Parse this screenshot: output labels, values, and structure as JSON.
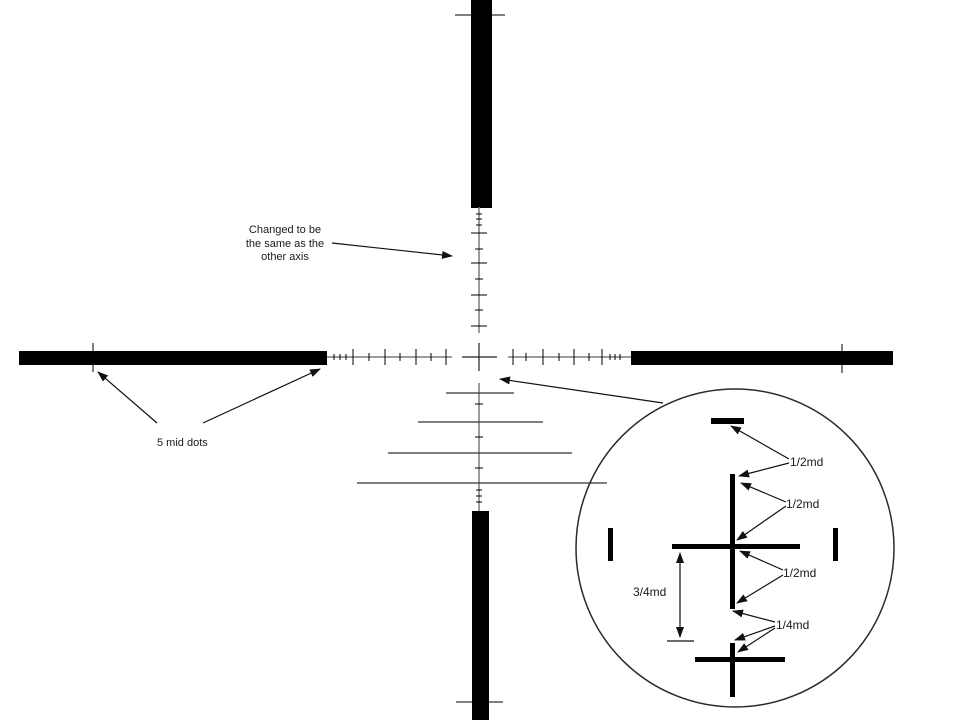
{
  "title": "Mil-dot reticle design diagram",
  "canvas": {
    "w": 960,
    "h": 720,
    "bg": "#ffffff"
  },
  "colors": {
    "ink": "#000000",
    "stem": "#7b7b7b",
    "cross": "#222222",
    "rung": "#333333",
    "tick": "#000000",
    "arrow": "#111111",
    "circle": "#2a2a2a",
    "text": "#1a1a1a"
  },
  "notes": {
    "axis_note": {
      "lines": [
        "Changed to be",
        "the same as the",
        "other axis"
      ]
    },
    "mid_dots_note": {
      "text": "5 mid dots"
    }
  },
  "inset": {
    "labels": [
      {
        "id": "half-md-1",
        "text": "1/2md"
      },
      {
        "id": "half-md-2",
        "text": "1/2md"
      },
      {
        "id": "half-md-3",
        "text": "1/2md"
      },
      {
        "id": "quarter-md",
        "text": "1/4md"
      },
      {
        "id": "three-quarter-md",
        "text": "3/4md"
      }
    ]
  },
  "geometry": {
    "bars": [
      {
        "id": "top-bar",
        "x": 471,
        "y": 0,
        "w": 21,
        "h": 208
      },
      {
        "id": "left-bar",
        "x": 19,
        "y": 351,
        "w": 308,
        "h": 14
      },
      {
        "id": "right-bar",
        "x": 631,
        "y": 351,
        "w": 262,
        "h": 14
      },
      {
        "id": "bottom-bar",
        "x": 472,
        "y": 511,
        "w": 17,
        "h": 209
      }
    ],
    "stems": [
      {
        "id": "upper-stem",
        "p": [
          479,
          207,
          479,
          333
        ]
      },
      {
        "id": "left-stem",
        "p": [
          327,
          357,
          452,
          357
        ]
      },
      {
        "id": "right-stem",
        "p": [
          508,
          357,
          631,
          357
        ]
      },
      {
        "id": "ladder-stem",
        "p": [
          479,
          383,
          479,
          511
        ]
      }
    ],
    "cross": [
      {
        "id": "center-cross-v",
        "p": [
          479,
          343,
          479,
          371
        ]
      },
      {
        "id": "center-cross-h",
        "p": [
          462,
          357,
          497,
          357
        ]
      }
    ],
    "rungs": [
      {
        "id": "ladder-rung-1",
        "p": [
          446,
          393,
          514,
          393
        ]
      },
      {
        "id": "ladder-rung-2",
        "p": [
          418,
          422,
          543,
          422
        ]
      },
      {
        "id": "ladder-rung-3",
        "p": [
          388,
          453,
          572,
          453
        ]
      },
      {
        "id": "ladder-rung-4",
        "p": [
          357,
          483,
          607,
          483
        ]
      }
    ],
    "ticks": [
      {
        "id": "top-bar-tick",
        "p": [
          455,
          15,
          505,
          15
        ]
      },
      {
        "id": "bottom-bar-tick",
        "p": [
          456,
          702,
          503,
          702
        ]
      },
      {
        "id": "left-bar-mid-dot-tick",
        "p": [
          93,
          343,
          93,
          372
        ]
      },
      {
        "id": "right-bar-mid-dot-tick",
        "p": [
          842,
          344,
          842,
          373
        ]
      },
      {
        "id": "upper-fine-tick",
        "p": [
          476,
          214,
          482,
          214
        ]
      },
      {
        "id": "upper-fine-tick",
        "p": [
          476,
          219,
          482,
          219
        ]
      },
      {
        "id": "upper-fine-tick",
        "p": [
          476,
          225,
          482,
          225
        ]
      },
      {
        "id": "upper-long-tick",
        "p": [
          471,
          233,
          487,
          233
        ]
      },
      {
        "id": "upper-short-tick",
        "p": [
          475,
          249,
          483,
          249
        ]
      },
      {
        "id": "upper-long-tick",
        "p": [
          471,
          263,
          487,
          263
        ]
      },
      {
        "id": "upper-short-tick",
        "p": [
          475,
          279,
          483,
          279
        ]
      },
      {
        "id": "upper-long-tick",
        "p": [
          471,
          295,
          487,
          295
        ]
      },
      {
        "id": "upper-short-tick",
        "p": [
          475,
          310,
          483,
          310
        ]
      },
      {
        "id": "upper-long-tick",
        "p": [
          471,
          326,
          487,
          326
        ]
      },
      {
        "id": "left-fine-tick",
        "p": [
          334,
          354,
          334,
          360
        ]
      },
      {
        "id": "left-fine-tick",
        "p": [
          340,
          354,
          340,
          360
        ]
      },
      {
        "id": "left-fine-tick",
        "p": [
          346,
          354,
          346,
          360
        ]
      },
      {
        "id": "left-long-tick",
        "p": [
          353,
          349,
          353,
          365
        ]
      },
      {
        "id": "left-short-tick",
        "p": [
          369,
          353,
          369,
          361
        ]
      },
      {
        "id": "left-long-tick",
        "p": [
          385,
          349,
          385,
          365
        ]
      },
      {
        "id": "left-short-tick",
        "p": [
          400,
          353,
          400,
          361
        ]
      },
      {
        "id": "left-long-tick",
        "p": [
          416,
          349,
          416,
          365
        ]
      },
      {
        "id": "left-short-tick",
        "p": [
          431,
          353,
          431,
          361
        ]
      },
      {
        "id": "left-long-tick",
        "p": [
          446,
          349,
          446,
          365
        ]
      },
      {
        "id": "right-long-tick",
        "p": [
          513,
          349,
          513,
          365
        ]
      },
      {
        "id": "right-short-tick",
        "p": [
          526,
          353,
          526,
          361
        ]
      },
      {
        "id": "right-long-tick",
        "p": [
          543,
          349,
          543,
          365
        ]
      },
      {
        "id": "right-short-tick",
        "p": [
          559,
          353,
          559,
          361
        ]
      },
      {
        "id": "right-long-tick",
        "p": [
          574,
          349,
          574,
          365
        ]
      },
      {
        "id": "right-short-tick",
        "p": [
          589,
          353,
          589,
          361
        ]
      },
      {
        "id": "right-long-tick",
        "p": [
          602,
          349,
          602,
          365
        ]
      },
      {
        "id": "right-fine-tick",
        "p": [
          610,
          354,
          610,
          360
        ]
      },
      {
        "id": "right-fine-tick",
        "p": [
          615,
          354,
          615,
          360
        ]
      },
      {
        "id": "right-fine-tick",
        "p": [
          620,
          354,
          620,
          360
        ]
      },
      {
        "id": "ladder-short-tick",
        "p": [
          475,
          404,
          483,
          404
        ]
      },
      {
        "id": "ladder-short-tick",
        "p": [
          475,
          437,
          483,
          437
        ]
      },
      {
        "id": "ladder-short-tick",
        "p": [
          475,
          468,
          483,
          468
        ]
      },
      {
        "id": "ladder-fine-tick",
        "p": [
          476,
          490,
          482,
          490
        ]
      },
      {
        "id": "ladder-fine-tick",
        "p": [
          476,
          496,
          482,
          496
        ]
      },
      {
        "id": "ladder-fine-tick",
        "p": [
          476,
          502,
          482,
          502
        ]
      }
    ],
    "circle": {
      "cx": 735,
      "cy": 548,
      "r": 159
    },
    "inset_rects": [
      {
        "id": "inset-top-bar",
        "x": 711,
        "y": 418,
        "w": 33,
        "h": 6
      },
      {
        "id": "inset-upper-vline",
        "x": 730,
        "y": 474,
        "w": 5,
        "h": 135
      },
      {
        "id": "inset-cross-hline",
        "x": 672,
        "y": 544,
        "w": 128,
        "h": 5
      },
      {
        "id": "inset-left-tick",
        "x": 608,
        "y": 528,
        "w": 5,
        "h": 33
      },
      {
        "id": "inset-right-tick",
        "x": 833,
        "y": 528,
        "w": 5,
        "h": 33
      },
      {
        "id": "inset-lower-vline",
        "x": 730,
        "y": 643,
        "w": 5,
        "h": 54
      },
      {
        "id": "inset-lower-hline",
        "x": 695,
        "y": 657,
        "w": 90,
        "h": 5
      }
    ],
    "arrows": [
      {
        "id": "axis-note-arrow",
        "p": [
          332,
          243,
          452,
          256
        ]
      },
      {
        "id": "mid-dots-arrow-left",
        "p": [
          157,
          423,
          98,
          372
        ]
      },
      {
        "id": "mid-dots-arrow-right",
        "p": [
          203,
          423,
          320,
          369
        ]
      },
      {
        "id": "inset-pointer-arrow",
        "p": [
          663,
          403,
          500,
          379
        ]
      },
      {
        "id": "half-md-1-arrow-top-bar",
        "p": [
          789,
          459,
          731,
          426
        ]
      },
      {
        "id": "half-md-1-arrow-line-top",
        "p": [
          789,
          463,
          739,
          476
        ]
      },
      {
        "id": "half-md-2-arrow-line-top",
        "p": [
          786,
          502,
          741,
          483
        ]
      },
      {
        "id": "half-md-2-arrow-cross",
        "p": [
          786,
          506,
          737,
          540
        ]
      },
      {
        "id": "half-md-3-arrow-cross",
        "p": [
          783,
          570,
          740,
          551
        ]
      },
      {
        "id": "half-md-3-arrow-line-bottom",
        "p": [
          783,
          575,
          737,
          603
        ]
      },
      {
        "id": "quarter-md-arrow-line-bottom",
        "p": [
          775,
          622,
          733,
          611
        ]
      },
      {
        "id": "quarter-md-arrow-lower-top",
        "p": [
          775,
          626,
          735,
          640
        ]
      },
      {
        "id": "quarter-md-arrow-lower-cross",
        "p": [
          775,
          628,
          738,
          652
        ]
      },
      {
        "id": "measure-arrow-up",
        "p": [
          680,
          595,
          680,
          553
        ]
      },
      {
        "id": "measure-arrow-down",
        "p": [
          680,
          595,
          680,
          637
        ]
      }
    ],
    "plain_lines": [
      {
        "id": "measure-base-tick",
        "p": [
          667,
          641,
          694,
          641
        ]
      }
    ]
  }
}
